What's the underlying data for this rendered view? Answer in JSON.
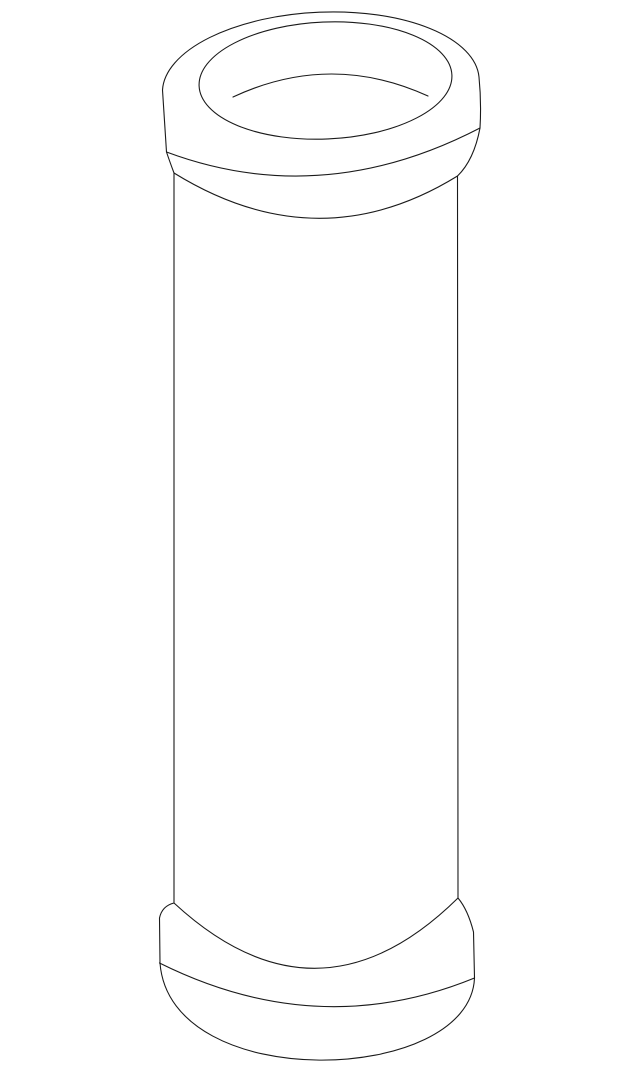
{
  "figure": {
    "title": "Line-art illustration of a hollow cylindrical tube with rounded flanged ends, viewed from slightly above",
    "type": "technical-line-drawing",
    "background_color": "#ffffff",
    "stroke_color": "#1a1a1a",
    "canvas": {
      "width": 640,
      "height": 1071,
      "viewbox": "0 0 640 1071"
    },
    "paths": {
      "silhouette": "M 162.5 90 A 158.5 74 -2.7 0 1 479 77 Q 481.5 102 480 128 Q 474 160 457.5 176 L 458 898 Q 468 910 473.5 932 L 474.5 978 C 470 1085 170 1095 160 963 L 159.5 918 Q 162 906 174 903 L 174 173 Q 169.5 161 166.5 152 L 162.5 90 Z",
      "top_opening_rim": "M 199.1 86 A 126.5 58.5 -2.5 1 1 451.9 75 A 126.5 58.5 -2.5 1 1 199.1 86 Z",
      "bore_inner_wall_arc": "M 233 97 Q 330.5 51.5 428 96",
      "top_flange_lower_edge": "M 166.5 152 Q 322 210 480 128",
      "top_flange_base_arc": "M 174 173 Q 318 262 457.5 176",
      "bottom_flange_top_arc": "M 174 903 Q 318 1036 458 898",
      "bottom_flange_lower_edge": "M 159.5 963 Q 318 1042 474.5 978"
    }
  }
}
